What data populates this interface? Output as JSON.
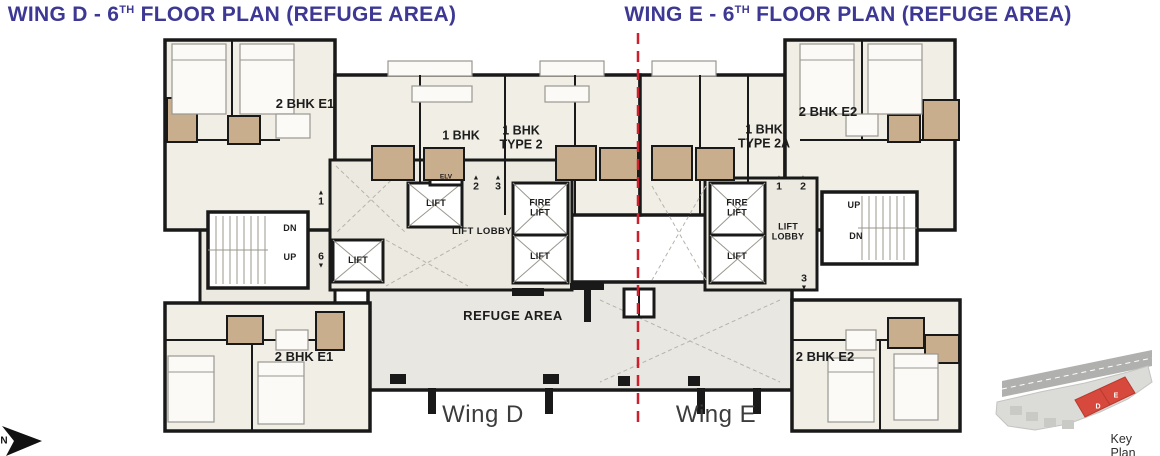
{
  "titles": {
    "wing_d": {
      "prefix": "WING D - 6",
      "sup": "TH",
      "suffix": " FLOOR PLAN (REFUGE AREA)"
    },
    "wing_e": {
      "prefix": "WING E - 6",
      "sup": "TH",
      "suffix": " FLOOR PLAN (REFUGE AREA)"
    }
  },
  "colors": {
    "title": "#3d3894",
    "divider_red": "#ce1f2d",
    "wall": "#191919",
    "room_fill": "#f0eee5",
    "bath_fill": "#c9ae8d",
    "refuge_fill": "#e8e7e2",
    "keyplan_building_red": "#d6493c"
  },
  "wing_d": {
    "bottom_label": "Wing D",
    "units": {
      "top": "2 BHK E1",
      "mid1": "1 BHK",
      "mid2_l1": "1 BHK",
      "mid2_l2": "TYPE 2",
      "bottom": "2 BHK E1"
    },
    "core": {
      "lift": "LIFT",
      "fire_l1": "FIRE",
      "fire_l2": "LIFT",
      "lift_lobby": "LIFT LOBBY",
      "elv": "ELV",
      "dn": "DN",
      "up": "UP"
    },
    "markers": {
      "m1": {
        "icon": "▲",
        "num": "1"
      },
      "m2": {
        "icon": "▲",
        "num": "2"
      },
      "m3": {
        "icon": "▲",
        "num": "3"
      },
      "m6": {
        "icon": "▼",
        "num": "6"
      }
    }
  },
  "wing_e": {
    "bottom_label": "Wing E",
    "units": {
      "top": "2 BHK E2",
      "mid_l1": "1 BHK",
      "mid_l2": "TYPE 2A",
      "bottom": "2 BHK E2"
    },
    "core": {
      "lift": "LIFT",
      "fire_l1": "FIRE",
      "fire_l2": "LIFT",
      "lobby_l1": "LIFT",
      "lobby_l2": "LOBBY",
      "up": "UP",
      "dn": "DN"
    },
    "markers": {
      "m1": {
        "icon": "▲",
        "num": "1"
      },
      "m2": {
        "icon": "▲",
        "num": "2"
      },
      "m3": {
        "icon": "▼",
        "num": "3"
      }
    }
  },
  "refuge": {
    "label": "REFUGE AREA"
  },
  "key_plan": {
    "label": "Key Plan",
    "building_d": "D",
    "building_e": "E"
  },
  "north": {
    "label": "N"
  }
}
